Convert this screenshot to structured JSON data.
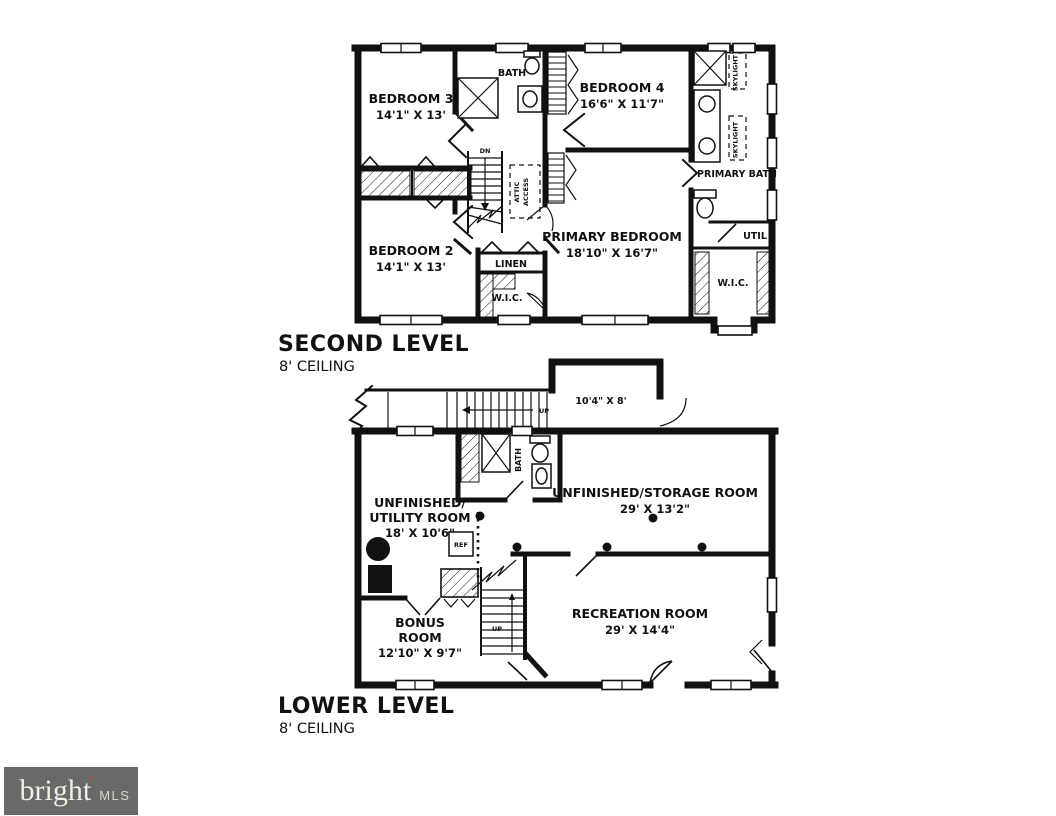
{
  "colors": {
    "ink": "#111111",
    "background": "#ffffff",
    "logo_bg": "#696969",
    "logo_text": "#f2eee4",
    "logo_mls": "#d7d3ca",
    "logo_accent": "#bf4434"
  },
  "second_level": {
    "title": "SECOND LEVEL",
    "ceiling": "8' CEILING",
    "rooms": {
      "bedroom3": {
        "name": "BEDROOM 3",
        "dims": "14'1\" X 13'"
      },
      "bedroom4": {
        "name": "BEDROOM 4",
        "dims": "16'6\" X 11'7\""
      },
      "bedroom2": {
        "name": "BEDROOM 2",
        "dims": "14'1\" X 13'"
      },
      "primary_bedroom": {
        "name": "PRIMARY BEDROOM",
        "dims": "18'10\" X 16'7\""
      }
    },
    "labels": {
      "bath": "BATH",
      "primary_bath": "PRIMARY BATH",
      "linen": "LINEN",
      "wic_hall": "W.I.C.",
      "wic_primary": "W.I.C.",
      "util": "UTIL",
      "skylight_upper": "SKYLIGHT",
      "skylight_lower": "SKYLIGHT",
      "attic_line1": "ATTIC",
      "attic_line2": "ACCESS",
      "dn": "DN"
    }
  },
  "lower_level": {
    "title": "LOWER LEVEL",
    "ceiling": "8' CEILING",
    "rooms": {
      "entry": {
        "dims": "10'4\" X 8'"
      },
      "utility": {
        "line1": "UNFINISHED/",
        "line2": "UTILITY ROOM",
        "dims": "18' X 10'6\""
      },
      "storage": {
        "name": "UNFINISHED/STORAGE ROOM",
        "dims": "29' X 13'2\""
      },
      "bonus": {
        "line1": "BONUS",
        "line2": "ROOM",
        "dims": "12'10\" X 9'7\""
      },
      "recreation": {
        "name": "RECREATION ROOM",
        "dims": "29' X 14'4\""
      }
    },
    "labels": {
      "up_top": "UP",
      "up_stairs": "UP",
      "bath": "BATH",
      "ref": "REF"
    }
  },
  "logo": {
    "brand": "bright",
    "mark": "*",
    "mls": "MLS"
  }
}
